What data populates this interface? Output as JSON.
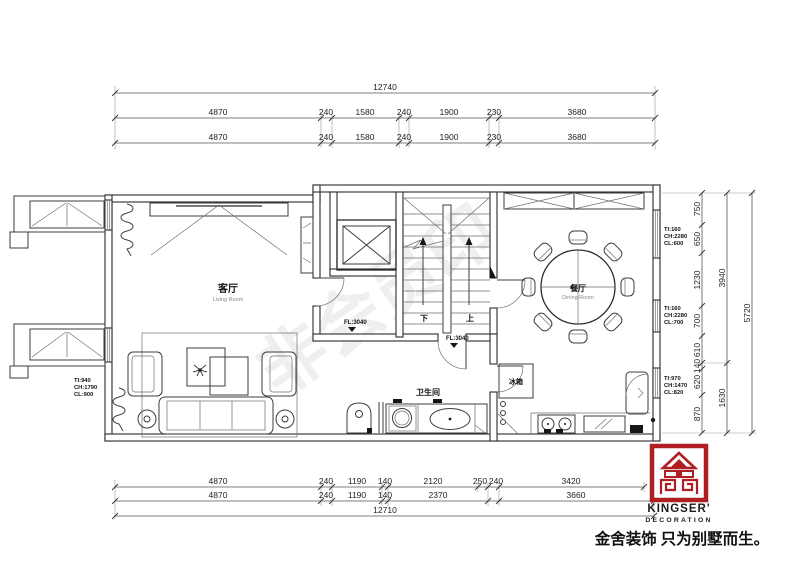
{
  "dimensions": {
    "top": {
      "overall": "12740",
      "row2": [
        "4870",
        "240",
        "1580",
        "240",
        "1900",
        "230",
        "3680"
      ],
      "row3": [
        "4870",
        "240",
        "1580",
        "240",
        "1900",
        "230",
        "3680"
      ]
    },
    "bottom": {
      "row1": [
        "4870",
        "240",
        "1190",
        "140",
        "2120",
        "250",
        "240",
        "3420"
      ],
      "row2": [
        "4870",
        "240",
        "1190",
        "140",
        "2370",
        "3660"
      ],
      "overall": "12710"
    },
    "right": {
      "inner": [
        "750",
        "650",
        "1230",
        "700",
        "610",
        "140",
        "620",
        "870"
      ],
      "middle": [
        "3940",
        "1630"
      ],
      "outer": "5720"
    }
  },
  "windows": {
    "left": {
      "lines": [
        "TI:940",
        "CH:1790",
        "CL:900"
      ]
    },
    "right_top": {
      "lines": [
        "TI:160",
        "CH:2280",
        "CL:600"
      ]
    },
    "right_middle": {
      "lines": [
        "TI:160",
        "CH:2280",
        "CL:700"
      ]
    },
    "right_bottom": {
      "lines": [
        "TI:970",
        "CH:1470",
        "CL:820"
      ]
    }
  },
  "levels": {
    "hall": "FL:3040",
    "bath": "FL:3040"
  },
  "rooms": {
    "living": {
      "zh": "客厅",
      "en": "Living Room"
    },
    "dining": {
      "zh": "餐厅",
      "en": "Dining Room"
    },
    "bathroom": {
      "zh": "卫生间"
    },
    "fridge": "冰箱"
  },
  "stairs": {
    "down": "下",
    "up": "上"
  },
  "branding": {
    "name": "KINGSER'",
    "subtitle": "DECORATION",
    "slogan": "金舍装饰 只为别墅而生。"
  },
  "watermark": "非会员印",
  "colors": {
    "line": "#2b2b2b",
    "brand_red": "#b01e23"
  }
}
